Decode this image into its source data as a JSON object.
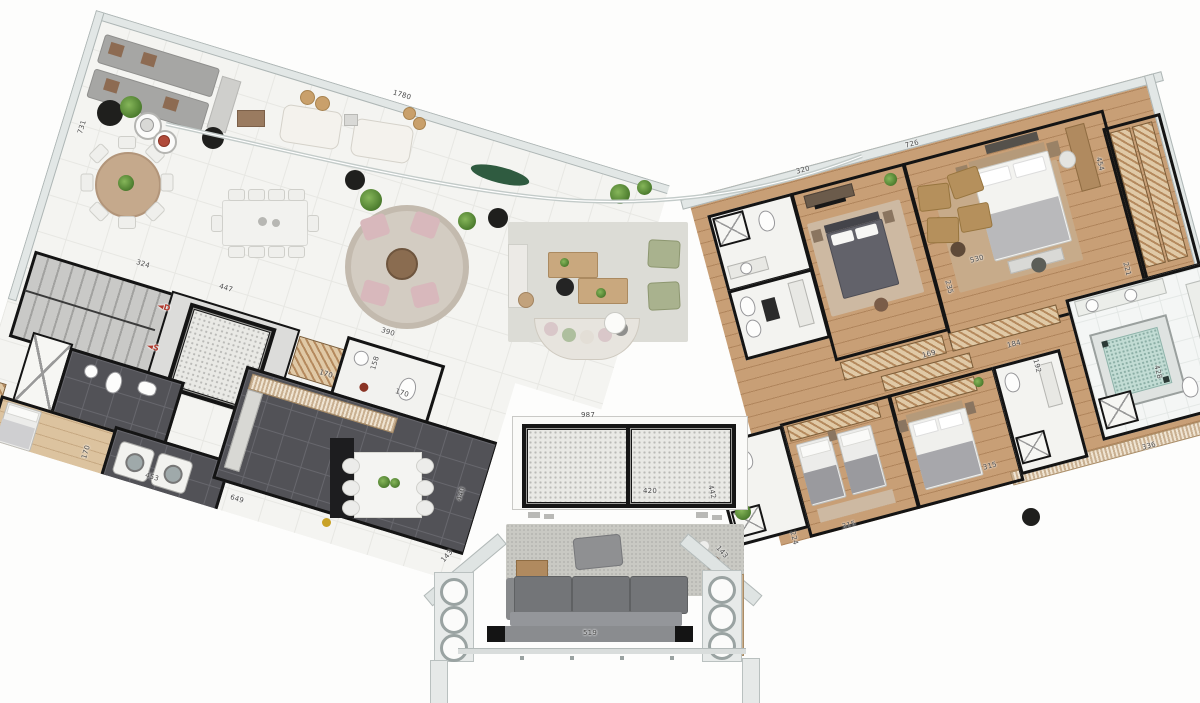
{
  "page": {
    "type": "architectural floor plan",
    "description": "Rendered top-down apartment plan with two angled wings, wrap-around terrace, central elevator core and entry hall"
  },
  "colors": {
    "background": "#fdfdfc",
    "terrace_tile": "#f4f4f1",
    "wood_floor": "#c89f76",
    "service_dark_tile": "#525257",
    "wall": "#141414",
    "slab_edge": "#e2e7e6",
    "jacuzzi": "#c2dcd4",
    "sofa_gray": "#737578",
    "hall_rug": "#c9c9c3",
    "stair_arrow_red": "#b03a2e",
    "closet_hatch": "#e0c9a6",
    "pouf_green": "#a9b28e",
    "pouf_pink": "#d8b8bc"
  },
  "stairs": {
    "down_label": "◄D",
    "up_label": "◄S"
  },
  "dimension_labels": [
    {
      "text": "1780",
      "x": 402,
      "y": 95,
      "r": 17
    },
    {
      "text": "731",
      "x": 82,
      "y": 127,
      "r": -73
    },
    {
      "text": "324",
      "x": 143,
      "y": 264,
      "r": 17
    },
    {
      "text": "447",
      "x": 226,
      "y": 288,
      "r": 17
    },
    {
      "text": "◄D",
      "x": 164,
      "y": 307,
      "r": 17,
      "accent": true
    },
    {
      "text": "◄S",
      "x": 153,
      "y": 347,
      "r": 17,
      "accent": true
    },
    {
      "text": "170",
      "x": 86,
      "y": 452,
      "r": -73
    },
    {
      "text": "453",
      "x": 152,
      "y": 477,
      "r": 17
    },
    {
      "text": "649",
      "x": 237,
      "y": 499,
      "r": 17
    },
    {
      "text": "390",
      "x": 388,
      "y": 332,
      "r": 17
    },
    {
      "text": "158",
      "x": 375,
      "y": 363,
      "r": -73
    },
    {
      "text": "170",
      "x": 326,
      "y": 374,
      "r": 17
    },
    {
      "text": "170",
      "x": 402,
      "y": 393,
      "r": 17
    },
    {
      "text": "440",
      "x": 461,
      "y": 494,
      "r": -73
    },
    {
      "text": "987",
      "x": 588,
      "y": 415,
      "r": 0
    },
    {
      "text": "420",
      "x": 650,
      "y": 491,
      "r": 0
    },
    {
      "text": "519",
      "x": 590,
      "y": 633,
      "r": 0
    },
    {
      "text": "143",
      "x": 447,
      "y": 556,
      "r": -48
    },
    {
      "text": "143",
      "x": 722,
      "y": 552,
      "r": 48
    },
    {
      "text": "726",
      "x": 912,
      "y": 144,
      "r": -15
    },
    {
      "text": "320",
      "x": 803,
      "y": 170,
      "r": -15
    },
    {
      "text": "454",
      "x": 1100,
      "y": 164,
      "r": 75
    },
    {
      "text": "530",
      "x": 977,
      "y": 259,
      "r": -15
    },
    {
      "text": "235",
      "x": 949,
      "y": 287,
      "r": 75
    },
    {
      "text": "221",
      "x": 1127,
      "y": 269,
      "r": 75
    },
    {
      "text": "169",
      "x": 929,
      "y": 354,
      "r": -15
    },
    {
      "text": "184",
      "x": 1014,
      "y": 344,
      "r": -15
    },
    {
      "text": "192",
      "x": 1037,
      "y": 366,
      "r": 75
    },
    {
      "text": "428",
      "x": 1158,
      "y": 372,
      "r": 75
    },
    {
      "text": "336",
      "x": 1149,
      "y": 446,
      "r": -15
    },
    {
      "text": "315",
      "x": 990,
      "y": 466,
      "r": -15
    },
    {
      "text": "315",
      "x": 849,
      "y": 525,
      "r": -15
    },
    {
      "text": "442",
      "x": 712,
      "y": 492,
      "r": 75
    },
    {
      "text": "224",
      "x": 794,
      "y": 538,
      "r": 75
    }
  ],
  "legend": {
    "terrace": "outdoor tiled deck with dining and lounge furniture",
    "service_wing": "stairs, service elevator, maid room, laundry, kitchen",
    "bedroom_wing": "master suite, three bedrooms, bathrooms, walk-in closets, jacuzzi bath",
    "core": "two passenger elevators and entry hall with sofa"
  }
}
